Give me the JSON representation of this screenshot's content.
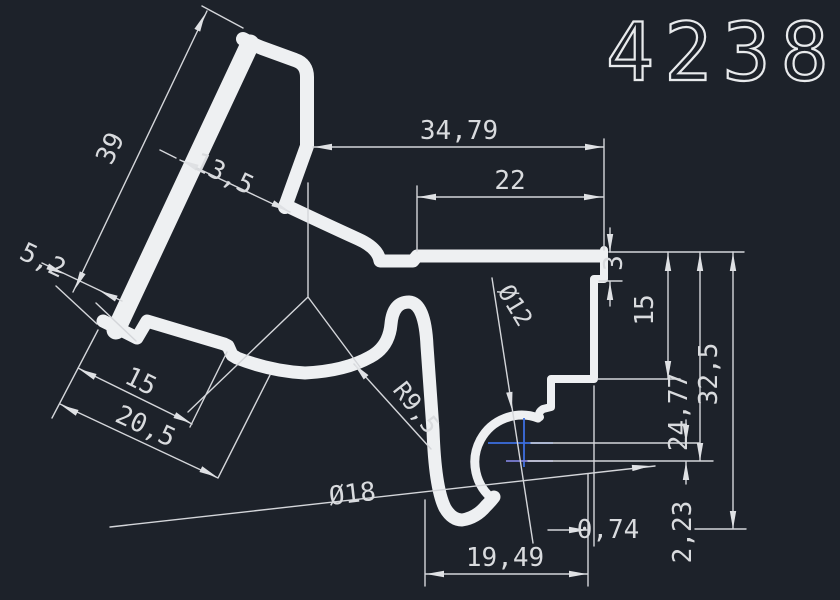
{
  "title": "4238",
  "dimensions": {
    "d39": "39",
    "d13_5": "13,5",
    "d5_2": "5,2",
    "d15_left": "15",
    "d20_5": "20,5",
    "d34_79": "34,79",
    "d22": "22",
    "d3": "3",
    "d15_right": "15",
    "d24_77": "24,77",
    "d32_5": "32,5",
    "d2_23": "2,23",
    "d0_74": "0,74",
    "d19_49": "19,49",
    "dia12": "Ø12",
    "dia18": "Ø18",
    "r9_5": "R9,5"
  },
  "colors": {
    "background": "#1d222a",
    "profile_line": "#eef0f2",
    "dimension_line": "#d4d6da",
    "dimension_text": "#d9dbde",
    "center_mark_blue": "#3d6fe0",
    "center_mark_purple": "#7d7fd6"
  }
}
